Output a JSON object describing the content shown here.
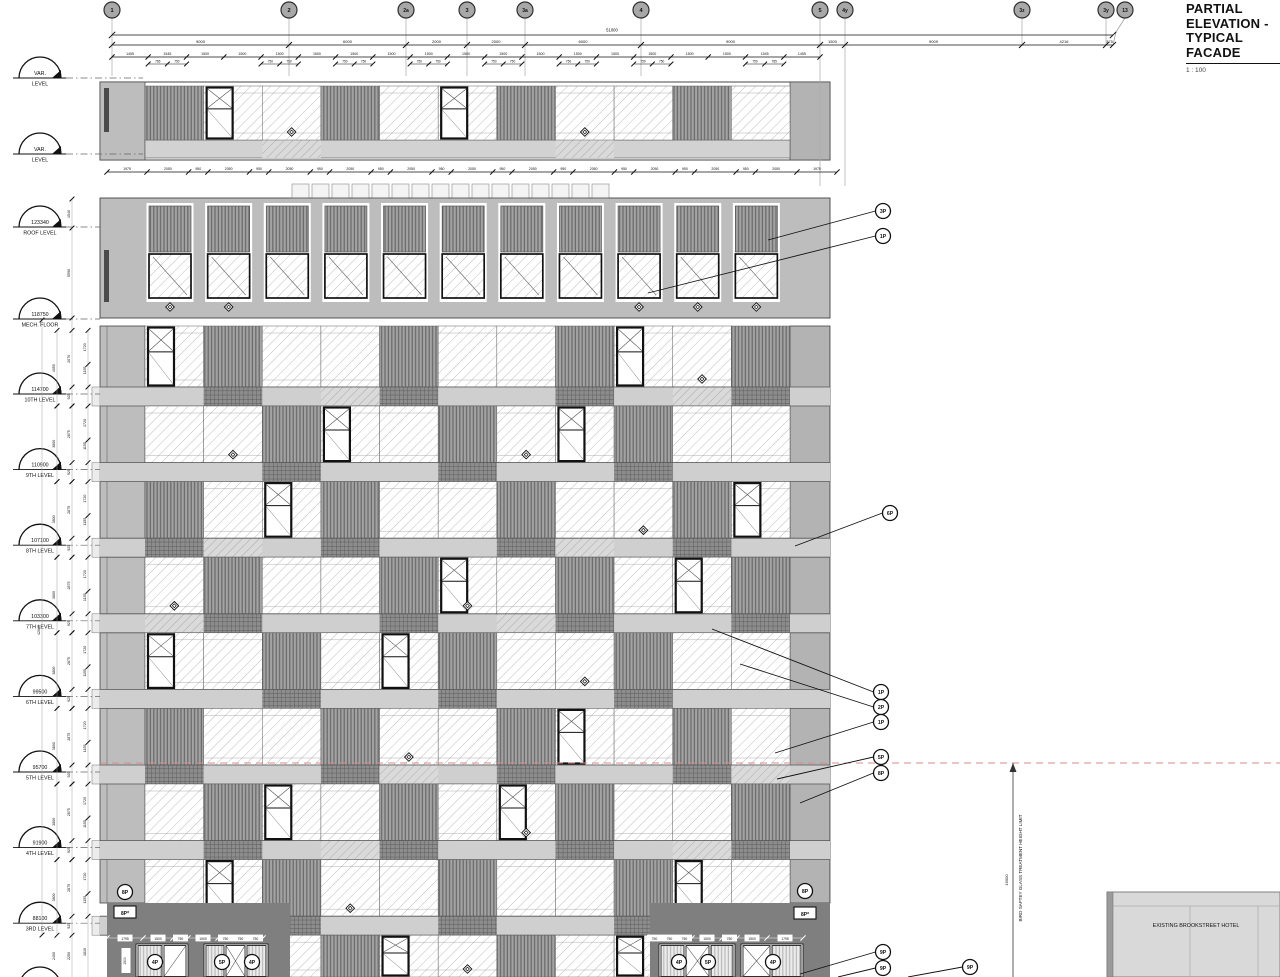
{
  "title": {
    "line1": "PARTIAL ELEVATION -",
    "line2": "TYPICAL FACADE",
    "scale": "1 : 100"
  },
  "grid": {
    "bubbles": [
      "1",
      "2",
      "2a",
      "3",
      "3a",
      "4",
      "5",
      "4y",
      "3z",
      "3y",
      "13"
    ]
  },
  "dims": {
    "overall": "51000",
    "majors": [
      "9000",
      "6000",
      "2000",
      "2000",
      "6000",
      "9000",
      "1500",
      "9009",
      "4216",
      "375"
    ],
    "minors": [
      "1455",
      "1545",
      "1500",
      "1500",
      "1500",
      "1500",
      "1500",
      "1500",
      "1500",
      "1500",
      "1500",
      "1500",
      "1500",
      "1500",
      "1500",
      "1500",
      "1500",
      "1545",
      "1455"
    ],
    "pair_left": [
      "765",
      "750"
    ],
    "pair": [
      "750",
      "750"
    ],
    "pair_right": [
      "750",
      "765"
    ],
    "window_row": [
      "1975",
      "2050",
      "950",
      "2050",
      "950",
      "2050",
      "950",
      "2050",
      "950",
      "2050",
      "950",
      "2050",
      "950",
      "2050",
      "950",
      "2050",
      "950",
      "2050",
      "950",
      "2050",
      "950",
      "2050",
      "1975"
    ],
    "floor": {
      "total": "3800",
      "mech_total": "4050",
      "a": "2875",
      "mech_a": "2070",
      "b": "925",
      "c": "1720",
      "d": "1155"
    },
    "roof": {
      "a": "1540",
      "b": "5590"
    },
    "body_total": "42040",
    "below_third": [
      "2400",
      "2250",
      "1810"
    ],
    "podium_left": [
      "1795",
      "1500",
      "750",
      "1500",
      "750",
      "750",
      "750"
    ],
    "podium_right": [
      "750",
      "750",
      "750",
      "1500",
      "750",
      "1500",
      "1795"
    ],
    "podium_vert": "1500",
    "bird_height": "16000"
  },
  "levels": [
    {
      "elev": "VAR.",
      "name": "LEVEL"
    },
    {
      "elev": "VAR.",
      "name": "LEVEL"
    },
    {
      "elev": "123340",
      "name": "ROOF LEVEL"
    },
    {
      "elev": "118750",
      "name": "MECH. FLOOR"
    },
    {
      "elev": "114700",
      "name": "10TH LEVEL"
    },
    {
      "elev": "110900",
      "name": "9TH LEVEL"
    },
    {
      "elev": "107100",
      "name": "8TH LEVEL"
    },
    {
      "elev": "103300",
      "name": "7TH LEVEL"
    },
    {
      "elev": "99500",
      "name": "6TH LEVEL"
    },
    {
      "elev": "95700",
      "name": "5TH LEVEL"
    },
    {
      "elev": "91900",
      "name": "4TH LEVEL"
    },
    {
      "elev": "88100",
      "name": "3RD LEVEL"
    }
  ],
  "callouts": {
    "roof": [
      "3P",
      "1P"
    ],
    "mid": "6P",
    "cluster": [
      "1P",
      "2P",
      "1P",
      "5P",
      "8P"
    ],
    "bottom": [
      "9P",
      "9P",
      "9P"
    ],
    "left_wall": {
      "circle": "8P",
      "box": "8P*"
    },
    "right_wall": {
      "circle": "8P",
      "box": "8P*"
    },
    "doors_left": [
      "4P",
      "5P",
      "4P"
    ],
    "doors_right": [
      "4P",
      "5P",
      "4P"
    ]
  },
  "notes": {
    "bird": "BIRD SAFTEY GLASS TREATMENT HEIGHT LIMIT",
    "hotel": "EXISTING BROOKSTREET HOTEL"
  }
}
